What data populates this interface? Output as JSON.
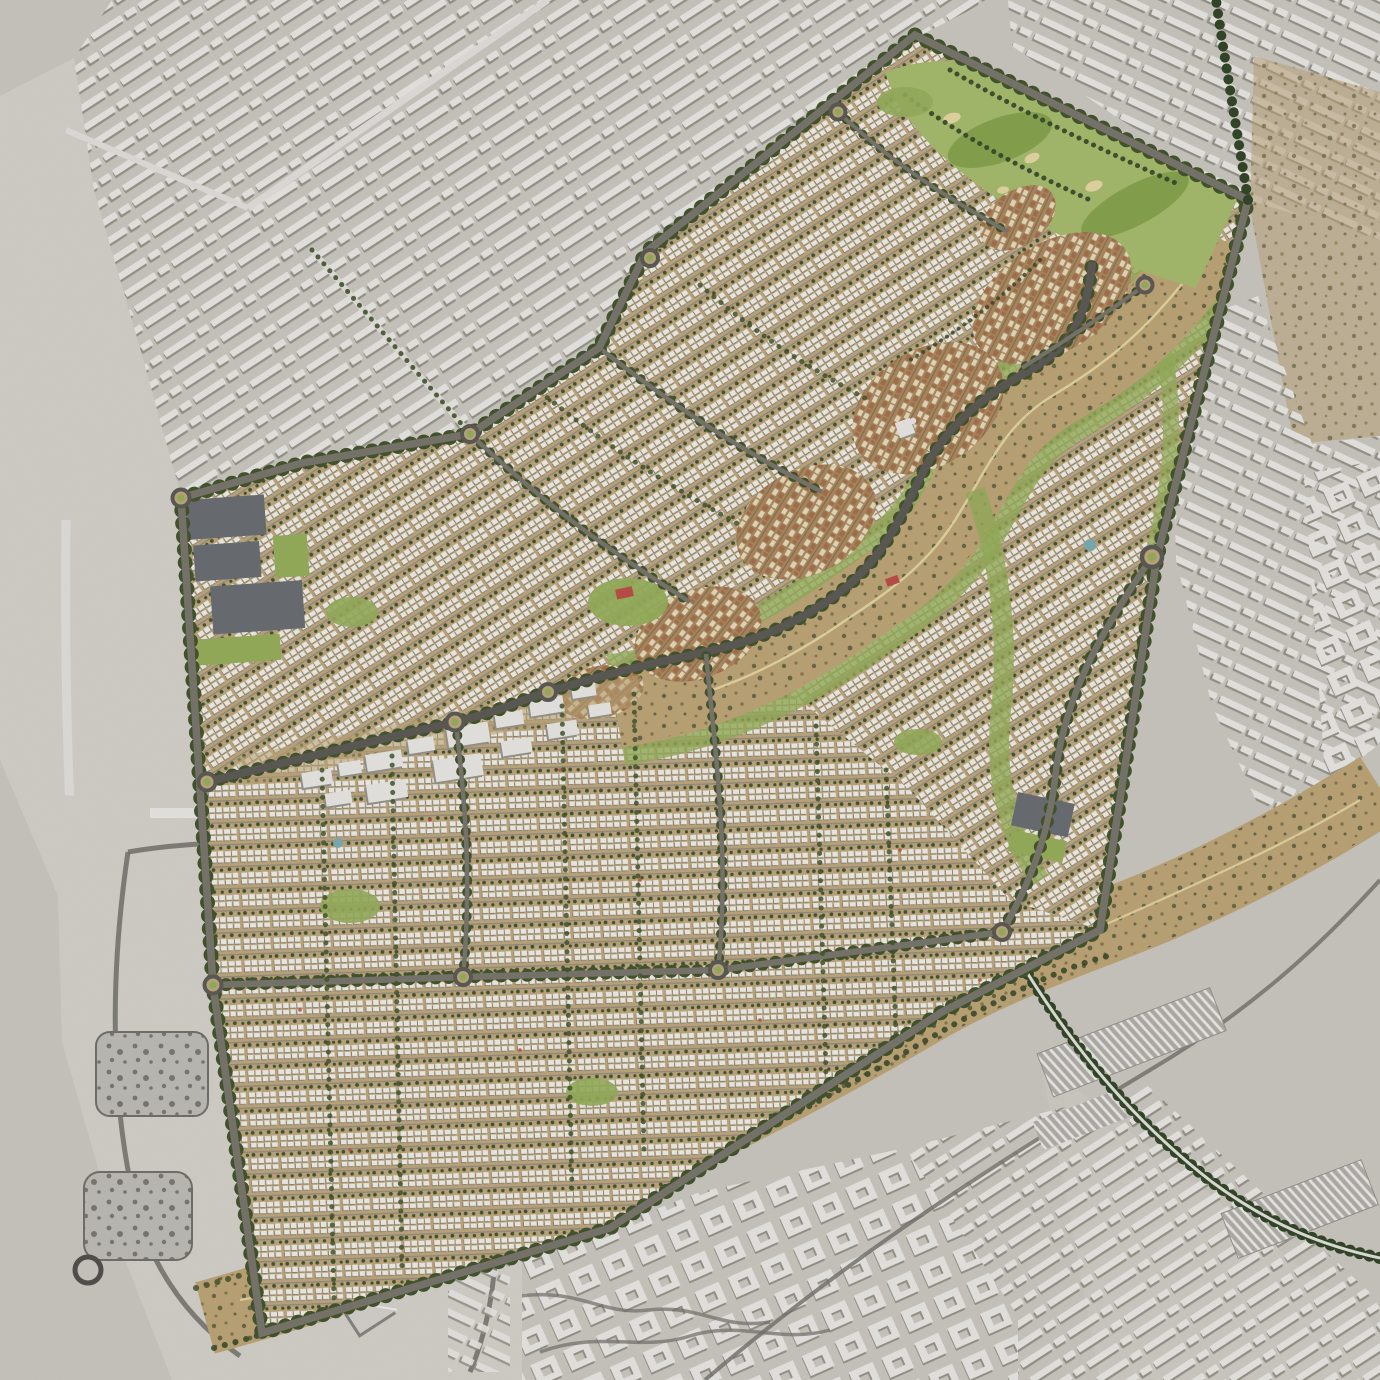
{
  "meta": {
    "title": "Aerial masterplan rendering",
    "view": "top-down satellite composite, new town masterplan in color over desaturated existing desert city"
  },
  "colors": {
    "desert_base": "#cfccc5",
    "desert_plain": "#d9d6cf",
    "bld_white": "#edece8",
    "bld_shadow": "#9b988f",
    "plan_sand": "#c2ab83",
    "street_gray": "#9a9181",
    "house_white": "#f5f3eb",
    "house_shadow": "#8e8672",
    "tree_green": "#46572e",
    "palm_green": "#36492a",
    "lawn_green": "#9ab35e",
    "golf_green": "#aabf70",
    "fairway_green": "#8aa851",
    "bunker_sand": "#e9dca6",
    "wadi_tan": "#c3a97b",
    "scrub_olive": "#6c6b47",
    "scrub_brown": "#8c7b52",
    "village_ground": "#ae8d63",
    "village_wall": "#ecdfbf",
    "village_roof": "#a97450",
    "road_dark": "#5f5d57",
    "road_mid": "#7c796f",
    "road_light": "#e7e5e0",
    "rail_gray": "#8f8d87",
    "stripe_base": "#b6b3ad",
    "stripe_light": "#f0efeb",
    "water_blue": "#7fb2b6",
    "court_red": "#c0524a",
    "tent_gray": "#d9d6d1",
    "tent_shadow": "#8b8984",
    "path_dark": "#76746e",
    "school_dark": "#6d7277"
  },
  "regions": {
    "masterplan": {
      "name": "new-community-masterplan",
      "elements": [
        "villa-grid-neighborhoods",
        "wadi-park-corridor",
        "heritage-village-clusters",
        "golf-course",
        "retail-spine",
        "school-campuses",
        "tree-lined-boulevards"
      ]
    },
    "surroundings": [
      {
        "name": "existing-city-northwest",
        "texture": "white slab housing rows on gray desert"
      },
      {
        "name": "existing-city-northeast",
        "texture": "white slab housing rows"
      },
      {
        "name": "existing-city-east",
        "texture": "slab and courtyard blocks"
      },
      {
        "name": "exhibition-compound-southwest",
        "texture": "large gray pavilion buildings with garden courts"
      },
      {
        "name": "industrial-district-south",
        "texture": "courtyard warehouses"
      },
      {
        "name": "industrial-district-southeast",
        "texture": "long warehouse slabs and rail yards"
      },
      {
        "name": "natural-wadi-corridor",
        "texture": "tan scrubland band with winding tracks"
      }
    ]
  },
  "features": {
    "roundabouts": 13,
    "village_clusters": 6,
    "golf_bunkers": 4,
    "school_campuses": 2,
    "ponds": 2,
    "rail_yards": 3,
    "tent_pavilions": 13
  }
}
